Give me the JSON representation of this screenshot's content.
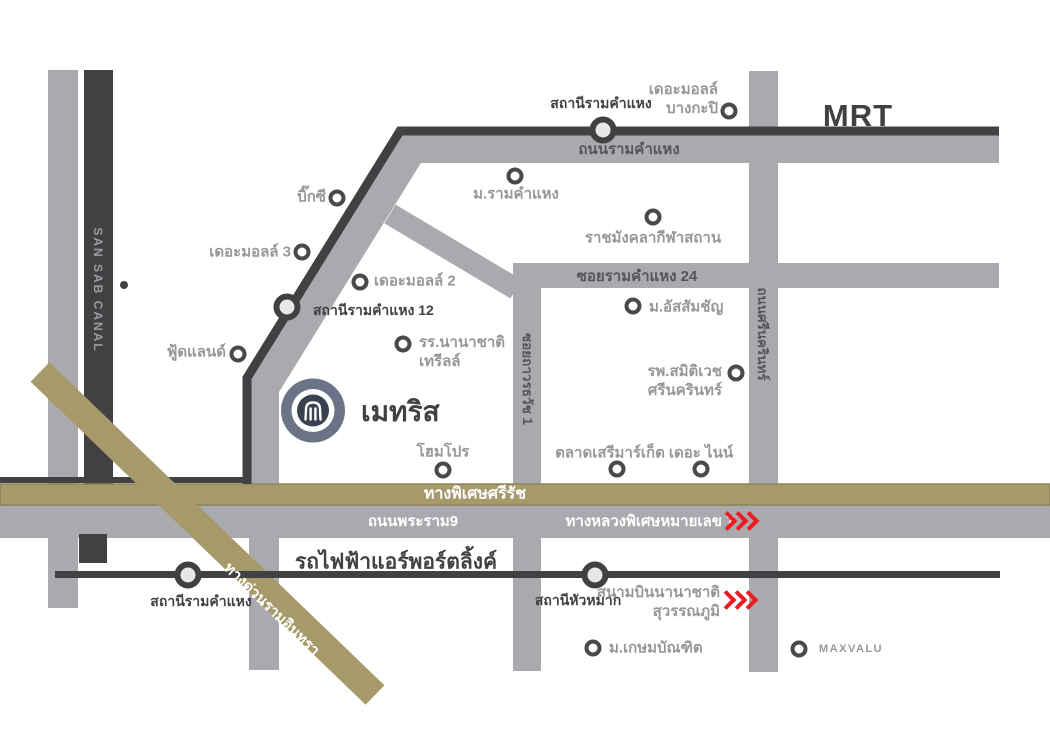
{
  "canal": {
    "label": "SAN SAB CANAL"
  },
  "transit": {
    "mrt": {
      "label": "MRT"
    },
    "airport_link": {
      "label": "รถไฟฟ้าแอร์พอร์ตลิ้งค์"
    },
    "stations": [
      {
        "name": "สถานีรามคำแหง"
      },
      {
        "name": "สถานีรามคำแหง 12"
      },
      {
        "name": "สถานีรามคำแหง"
      },
      {
        "name": "สถานีหัวหมาก"
      }
    ]
  },
  "roads": {
    "ramkhamhaeng": "ถนนรามคำแหง",
    "soi_ramkhamhaeng_24": "ซอยรามคำแหง 24",
    "srinakarin": "ถนนศรีนครินทร์",
    "soi_thawonthawat": "ซอยถาวรธวัช 1",
    "sirat_expressway": "ทางพิเศษศรีรัช",
    "rama9": "ถนนพระราม9",
    "motorway7": "ทางหลวงพิเศษหมายเลข 7",
    "ramindra_expressway": "ทางด่วนรามอินทรา"
  },
  "project": {
    "name": "เมทริส"
  },
  "destination_airport": {
    "lines": [
      "สนามบินนานาชาติ",
      "สุวรรณภูมิ"
    ]
  },
  "pois": [
    {
      "lines": [
        "เดอะมอลล์",
        "บางกะปิ"
      ]
    },
    {
      "label": "บิ๊กซี"
    },
    {
      "label": "เดอะมอลล์ 3"
    },
    {
      "label": "เดอะมอลล์ 2"
    },
    {
      "label": "ม.รามคำแหง"
    },
    {
      "label": "ราชมังคลากีฬาสถาน"
    },
    {
      "label": "ม.อัสสัมชัญ"
    },
    {
      "label": "ฟู้ดแลนด์"
    },
    {
      "lines": [
        "รร.นานาชาติ",
        "เทรีลล์"
      ]
    },
    {
      "lines": [
        "รพ.สมิติเวช",
        "ศรีนครินทร์"
      ]
    },
    {
      "label": "โฮมโปร"
    },
    {
      "label": "ตลาดเสรีมาร์เก็ต"
    },
    {
      "label": "เดอะ ไนน์"
    },
    {
      "label": "ม.เกษมบัณฑิต"
    },
    {
      "label": "MAXVALU"
    }
  ],
  "colors": {
    "road_gray": "#a8aaad",
    "dark_line": "#414042",
    "expressway_gold": "#a6996a",
    "chevron_red": "#ed1c24",
    "poi_text_gray": "#95979a",
    "logo_ring": "#6b7486",
    "logo_core": "#3a4150"
  }
}
